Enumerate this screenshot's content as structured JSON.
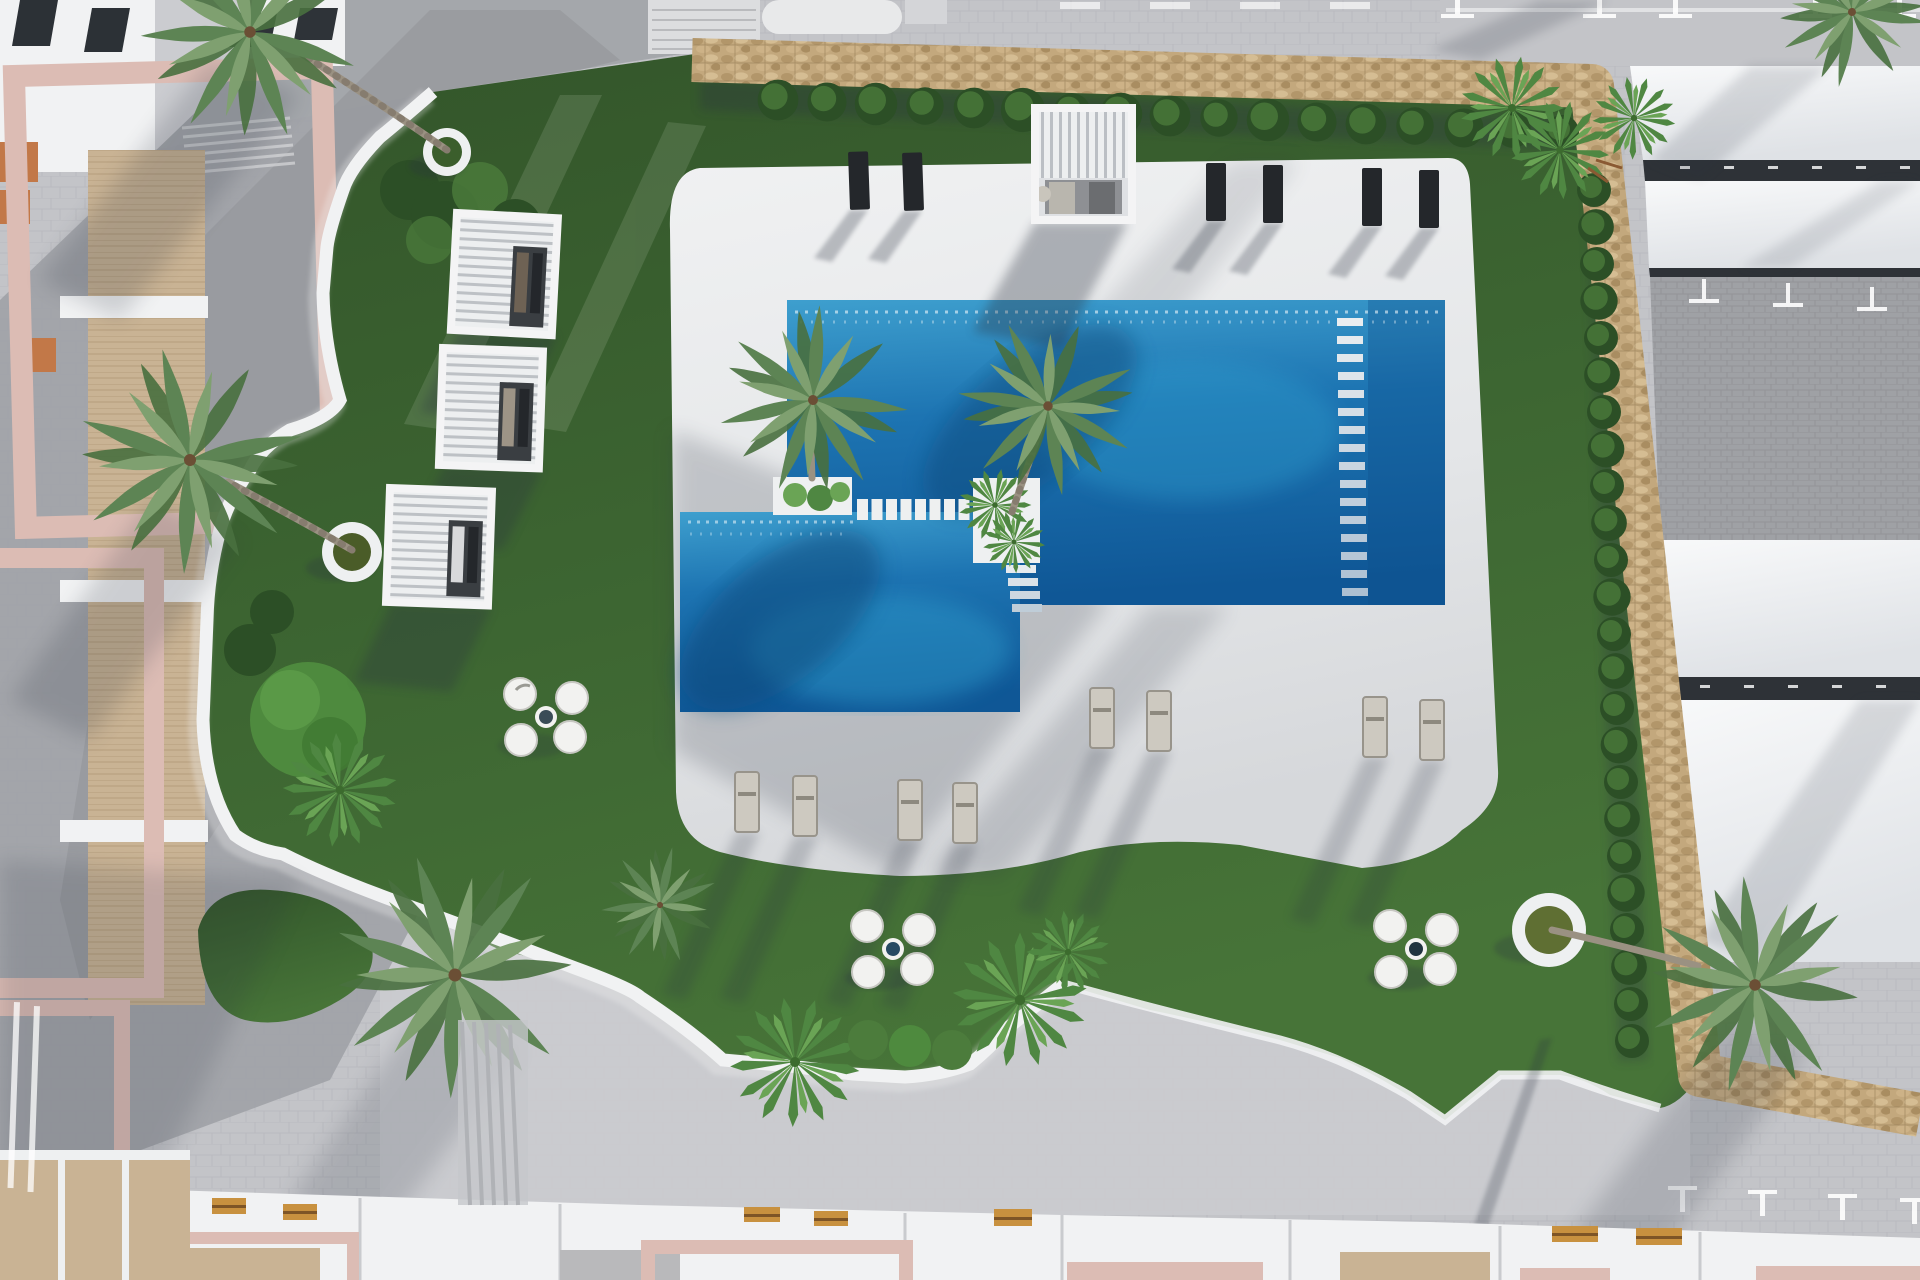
{
  "meta": {
    "title": "Aerial top-down 3D architectural rendering of a residential resort pool courtyard",
    "view": "top-down aerial",
    "style": "photorealistic architectural visualization",
    "visible_text": "none"
  },
  "colors": {
    "paving": "#c3c4c8",
    "paving_light": "#cbccd0",
    "paving_dark": "#9da0a5",
    "deck_white": "#e9eaeb",
    "grass_green": "#3d6632",
    "grass_dark": "#2c4f26",
    "grass_light": "#4c7c3c",
    "water_deep": "#0f5796",
    "water_mid": "#1a6fae",
    "water_bright": "#2f9ccc",
    "stone_tan": "#c3a87d",
    "stone_dark": "#8d7550",
    "white_structure": "#f1f2f3",
    "roof_white": "#f4f5f6",
    "roof_gap_dark": "#2e3237",
    "roof_gray": "#9fa1a5",
    "pink_frame": "#dcbcb4",
    "wood_floor": "#c9b394",
    "bench_wood": "#c8913f",
    "lounger_dark": "#24272b",
    "lounger_light": "#cdc9c0",
    "lounger_frame": "#98948b",
    "palm_light": "#7fa070",
    "palm_mid": "#5d8454",
    "palm_dark": "#49703f",
    "fan_palm": "#4f8742",
    "fan_palm_light": "#6aa455",
    "shadow": "#2c3340",
    "pool_table_navy": "#274a63"
  },
  "scene": {
    "pool": {
      "shape": "two overlapping rectangles (upper-right and lower-left)",
      "features": [
        "stepping-stone bridge of 8 white pads",
        "two white planter islands with palms",
        "wide white entry-step ladder on right side",
        "small corner steps below right island",
        "sparkling waterline"
      ]
    },
    "counts": {
      "pergola_cabanas": 4,
      "dark_sun_loungers_top": 6,
      "light_sun_loungers_bottom": 8,
      "pod_chair_sets": 3,
      "pod_chairs_per_set": 4,
      "round_wall_planters": 3,
      "large_palm_trees": 8,
      "fan_palm_clusters": 7,
      "hedge_bushes_top_row": 17,
      "hedge_bushes_right_column": 24,
      "stepping_stones": 8,
      "entry_step_rungs": 16,
      "wood_benches_bottom": 7
    },
    "materials": [
      "white concrete pool deck",
      "lawn",
      "dry-stone perimeter wall",
      "gray paver plaza",
      "white slatted carport roofs",
      "pink building frames",
      "wood terrace flooring"
    ]
  }
}
